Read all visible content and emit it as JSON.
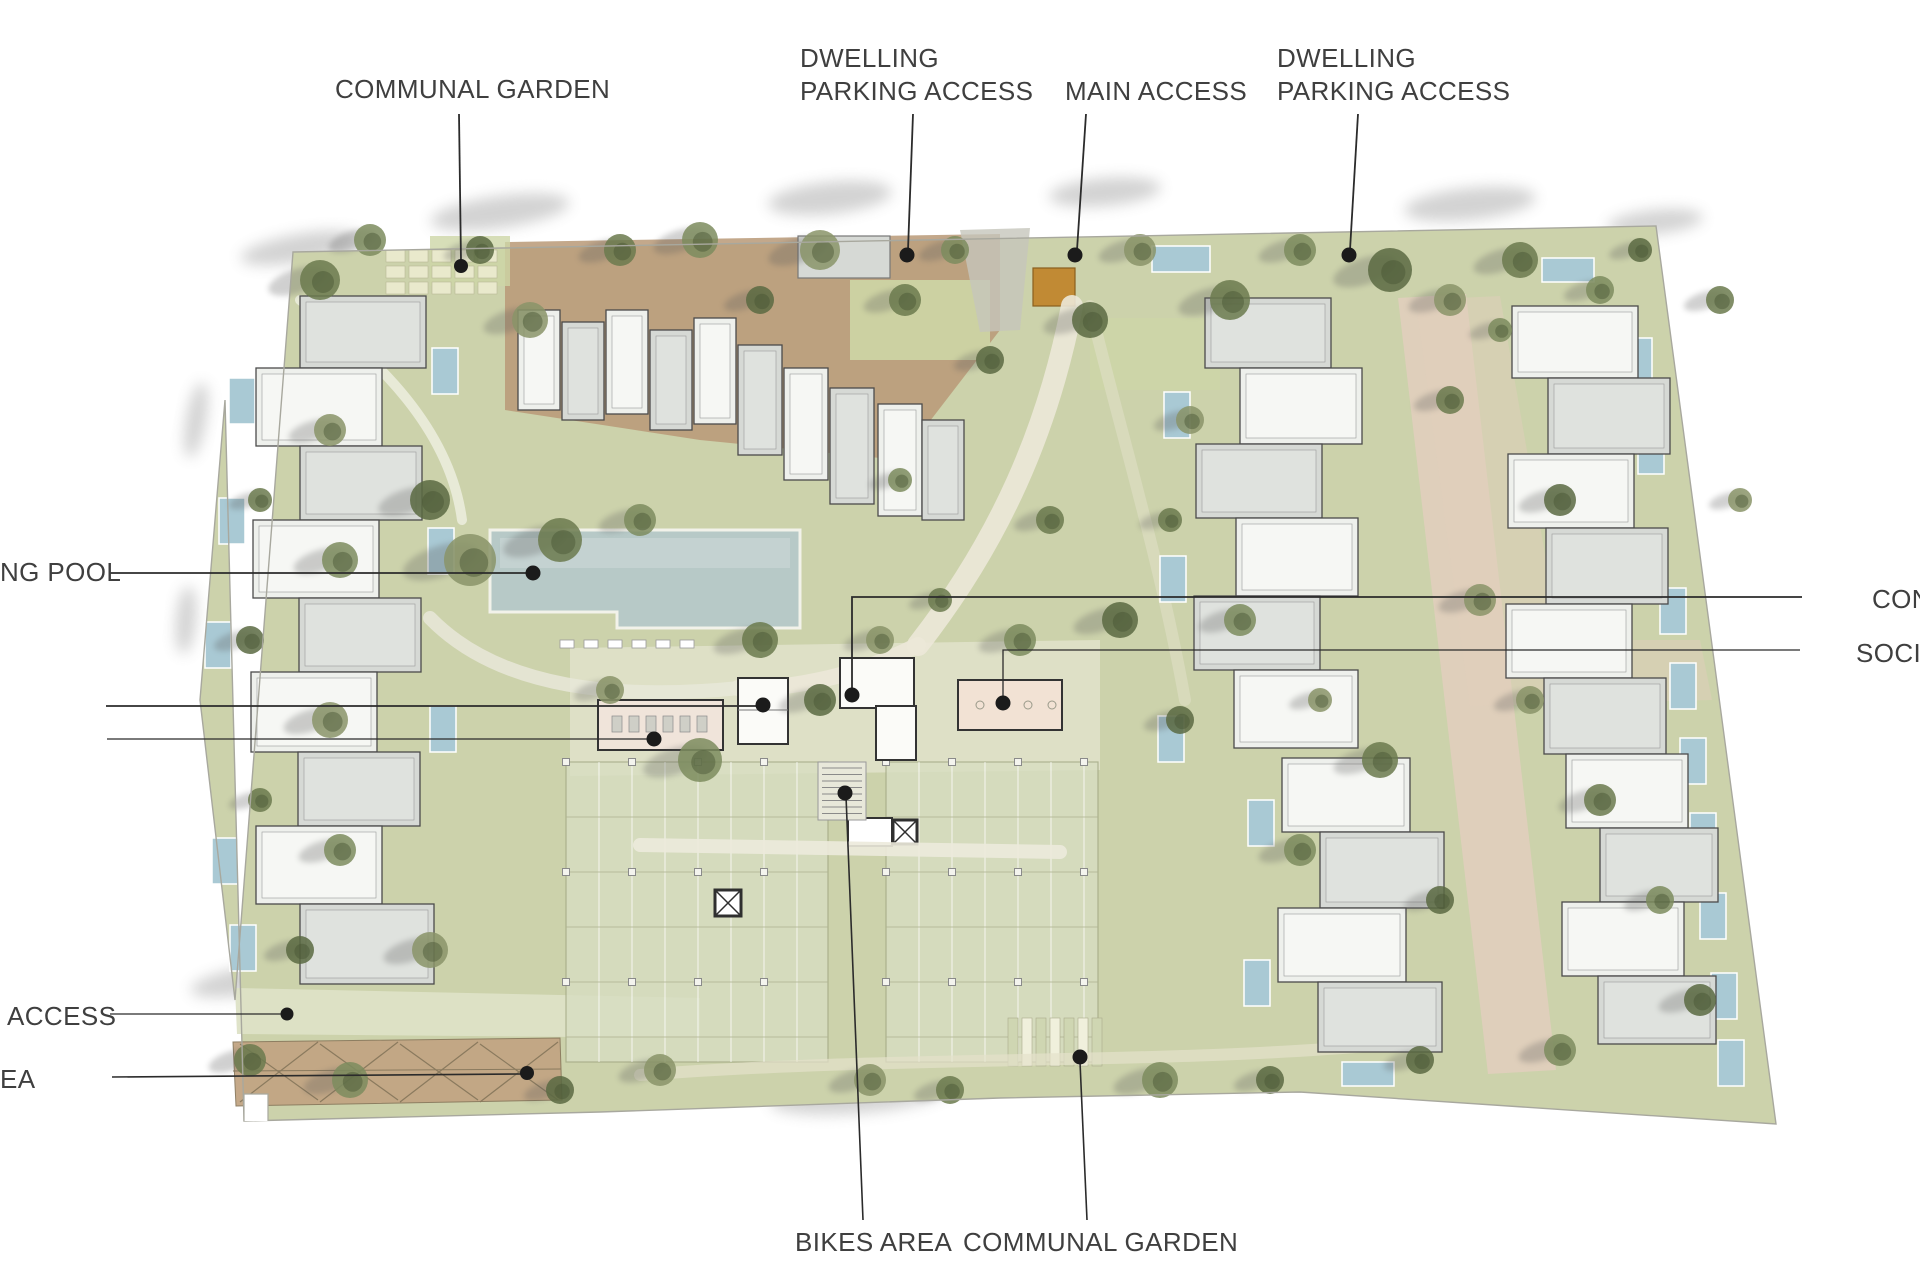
{
  "labels": {
    "communal_garden_top": {
      "text": "COMMUNAL GARDEN"
    },
    "dwelling_parking_left": {
      "line1": "DWELLING",
      "line2": "PARKING ACCESS"
    },
    "main_access": {
      "text": "MAIN ACCESS"
    },
    "dwelling_parking_right": {
      "line1": "DWELLING",
      "line2": "PARKING ACCESS"
    },
    "swimming_pool_truncated": {
      "text": "NG POOL"
    },
    "access_truncated": {
      "text": "ACCESS"
    },
    "area_truncated": {
      "text": "EA"
    },
    "bikes_area": {
      "text": "BIKES AREA"
    },
    "communal_garden_bottom": {
      "text": "COMMUNAL GARDEN"
    },
    "con_truncated": {
      "text": "CON"
    },
    "socia_truncated": {
      "text": "SOCIA"
    }
  },
  "colors": {
    "background": "#ffffff",
    "label_text": "#3f3f3f",
    "leader_line": "#2b2b2b",
    "site_green": "#ccd2ab",
    "lawn_light": "#d5dab6",
    "pool_blue": "#b7c9c7",
    "small_pool_blue": "#a9c9d4",
    "deck_brown": "#b99977",
    "building_white": "#eef0ec",
    "building_gray": "#d6d9d5",
    "building_stroke": "#4b4b4b",
    "entrance_ochre": "#c18a34",
    "paving_terracotta": "#e2cfbd",
    "plaza_pale": "#e9e9d8",
    "garden_bed": "#e9e9cc",
    "parking_lawn": "#d8dec2",
    "pergola_tan": "#c2a583",
    "tree_green": "#6b7a4e",
    "boundary_gray": "#a8a89e"
  }
}
